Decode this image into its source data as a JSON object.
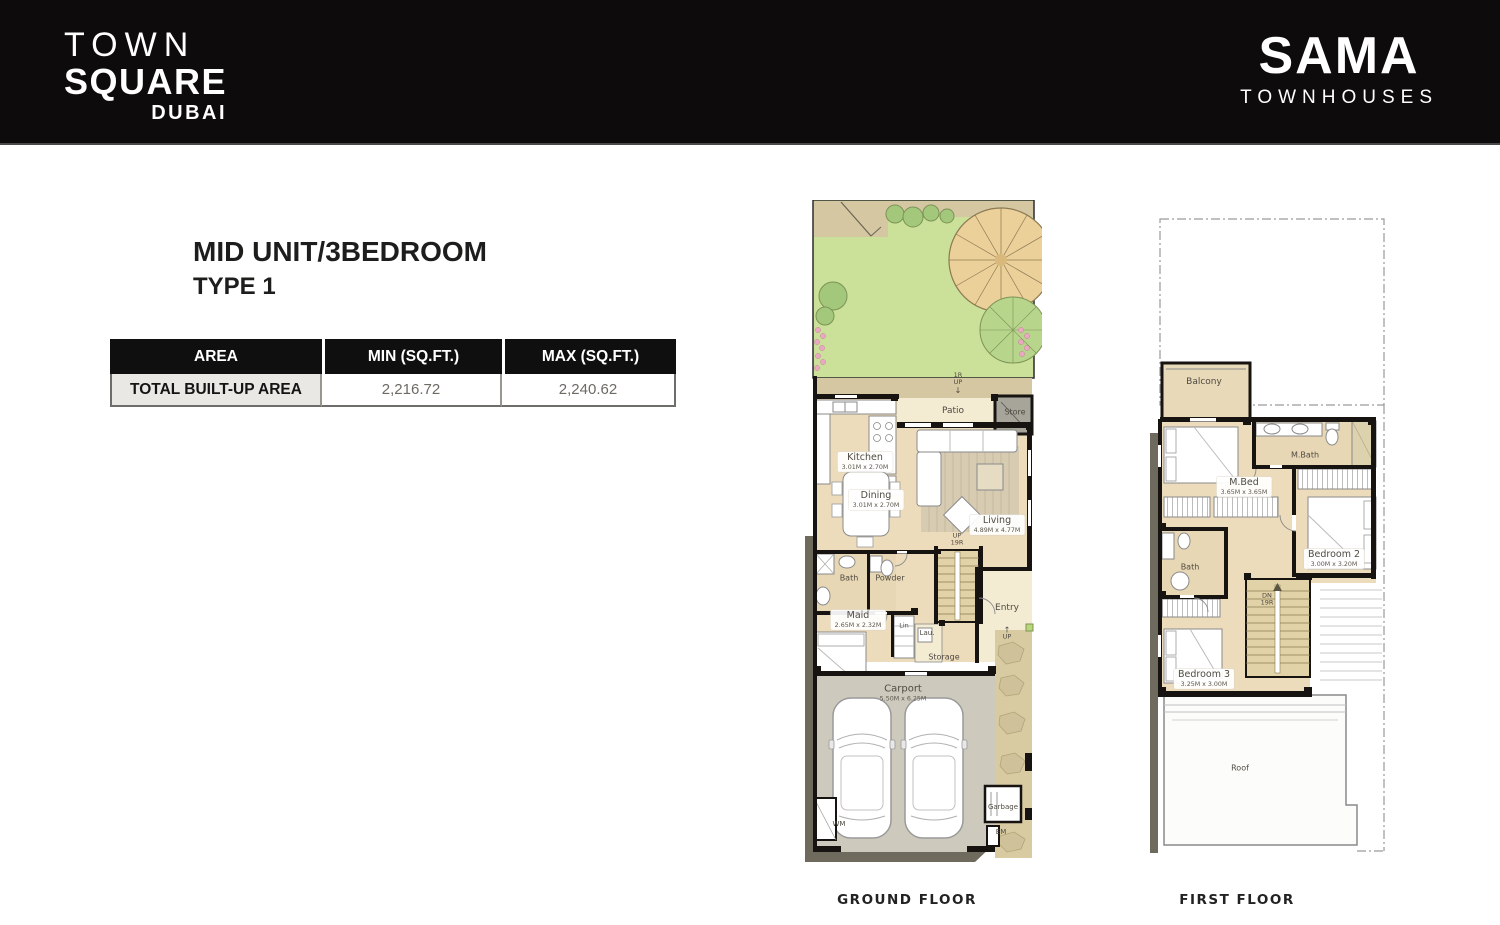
{
  "colors": {
    "header_bg": "#0d0b0c",
    "brand_text": "#ffffff",
    "lawn_green": "#cbe098",
    "floor_beige": "#eddcbb",
    "patio_cream": "#f4ebd3",
    "carport_grey": "#cdcabd",
    "wall_black": "#161311",
    "table_header_bg": "#0f0f0f",
    "table_row_label_bg": "#e9e8e5"
  },
  "header": {
    "brand_line1": "TOWN",
    "brand_line2": "SQUARE",
    "brand_line3": "DUBAI",
    "project_name": "SAMA",
    "project_sub": "TOWNHOUSES"
  },
  "title": {
    "line1": "MID UNIT/3BEDROOM",
    "line2": "TYPE 1"
  },
  "area_table": {
    "col_area": "AREA",
    "col_min": "MIN (SQ.FT.)",
    "col_max": "MAX (SQ.FT.)",
    "rows": [
      {
        "label": "TOTAL BUILT-UP AREA",
        "min": "2,216.72",
        "max": "2,240.62"
      }
    ]
  },
  "ground_floor": {
    "caption": "GROUND FLOOR",
    "labels": {
      "steps": {
        "l1": "1R",
        "l2": "UP",
        "arrow": "↓"
      },
      "patio": "Patio",
      "store": "Store",
      "kitchen": {
        "name": "Kitchen",
        "dims": "3.01M x 2.70M"
      },
      "dining": {
        "name": "Dining",
        "dims": "3.01M x 2.70M"
      },
      "living": {
        "name": "Living",
        "dims": "4.89M x 4.77M"
      },
      "stairs": {
        "l1": "UP",
        "l2": "19R"
      },
      "bath": "Bath",
      "powder": "Powder",
      "maid": {
        "name": "Maid",
        "dims": "2.65M x 2.32M"
      },
      "lin": "Lin",
      "lau": "Lau.",
      "entry": {
        "name": "Entry",
        "arrow": "↑",
        "up": "UP"
      },
      "storage": "Storage",
      "carport": {
        "name": "Carport",
        "dims": "5.50M x 6.25M"
      },
      "wm": "WM",
      "garbage": "Garbage",
      "em": "EM"
    }
  },
  "first_floor": {
    "caption": "FIRST FLOOR",
    "labels": {
      "balcony": "Balcony",
      "mbed": {
        "name": "M.Bed",
        "dims": "3.65M x 3.65M"
      },
      "mbath": "M.Bath",
      "bath": "Bath",
      "bedroom2": {
        "name": "Bedroom 2",
        "dims": "3.00M x 3.20M"
      },
      "stairs": {
        "l1": "DN",
        "l2": "19R"
      },
      "bedroom3": {
        "name": "Bedroom 3",
        "dims": "3.25M x 3.00M"
      },
      "roof": "Roof"
    }
  }
}
